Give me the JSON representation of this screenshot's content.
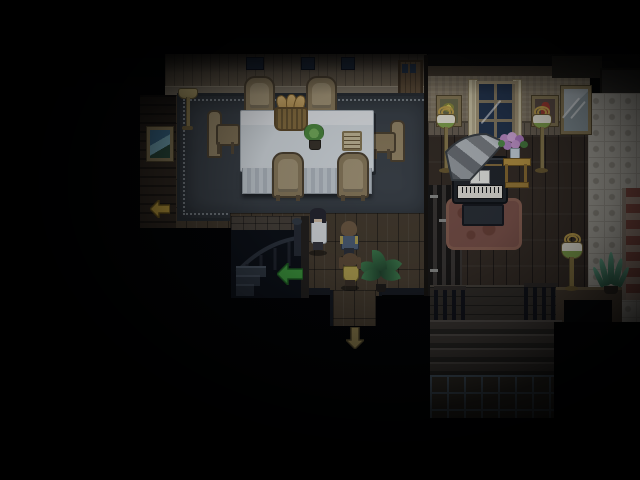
{
  "meta": {
    "genre": "top-down pixel-art RPG interior",
    "time_of_day": "night",
    "hud_text_visible": false
  },
  "scene": {
    "rooms": {
      "dining_room": {
        "label": "dining room",
        "objects": {
          "table": {
            "label": "long dining table with white tablecloth"
          },
          "bread_basket": {
            "label": "wicker basket with bread loaves"
          },
          "centerpiece": {
            "label": "green potted plant centerpiece"
          },
          "book": {
            "label": "open book on table"
          },
          "chair": {
            "label": "wooden dining chair",
            "count": 6
          },
          "rug": {
            "label": "large dark rug with dotted border"
          },
          "floor_lamp": {
            "label": "brass floor lamp"
          },
          "painting": {
            "label": "framed blue painting on left wall"
          },
          "back_door": {
            "label": "wooden door in back wall"
          },
          "small_windows": {
            "label": "dark transom windows",
            "count": 3
          }
        }
      },
      "hallway": {
        "label": "hallway",
        "objects": {
          "stairwell": {
            "label": "dark staircase leading down"
          },
          "houseplant": {
            "label": "potted palm plant"
          }
        }
      },
      "music_room": {
        "label": "music room",
        "objects": {
          "grand_piano": {
            "label": "black grand piano with open lid and sheet music"
          },
          "piano_bench": {
            "label": "piano bench"
          },
          "piano_rug": {
            "label": "round dusty-red rug"
          },
          "window": {
            "label": "night window with cream curtains"
          },
          "painting_flowers": {
            "label": "framed still-life painting"
          },
          "painting_portrait": {
            "label": "framed portrait in red"
          },
          "floor_lamp_left": {
            "label": "floor lamp with green-trimmed shade"
          },
          "floor_lamp_right": {
            "label": "floor lamp with green-trimmed shade"
          },
          "mirror": {
            "label": "wall mirror"
          },
          "flower_stand": {
            "label": "side table with vase of pink flowers"
          },
          "green_lamp": {
            "label": "floor lamp on patterned floor"
          },
          "aloe_plant": {
            "label": "spiky potted plant"
          },
          "patterned_floor": {
            "label": "light patterned tile area with red medallion border"
          }
        }
      },
      "foyer_stairs": {
        "label": "wide staircase to lower floor",
        "objects": {
          "railing": {
            "label": "banister with balusters"
          },
          "steps": {
            "label": "wooden steps"
          },
          "tile_floor": {
            "label": "checkered tile landing"
          }
        }
      }
    },
    "characters": [
      {
        "id": "adult-in-white-coat",
        "description": "dark-haired adult in a white coat, facing the viewer",
        "location": "hallway"
      },
      {
        "id": "boy-in-overalls",
        "description": "brown-haired boy in blue overalls over a yellow shirt, facing away",
        "location": "hallway"
      },
      {
        "id": "girl-in-yellow-dress",
        "description": "girl with pigtails in a yellow dress, facing away",
        "location": "hallway"
      }
    ],
    "exit_arrows": [
      {
        "id": "west-exit-arrow",
        "direction": "left",
        "color": "#c7a33c"
      },
      {
        "id": "stairs-down-arrow",
        "direction": "left",
        "color": "#3e9a3c"
      },
      {
        "id": "south-exit-arrow",
        "direction": "down",
        "color": "#93824e"
      }
    ],
    "palette": {
      "background": "#000000",
      "floor_wood": "#463b2d",
      "rug": "#3d4349",
      "tablecloth": "#e3e7ea",
      "piano_black": "#22262b",
      "piano_rug_red": "#7b5147",
      "window_night": "#24344e",
      "pattern_floor": "#b0aca2",
      "red_medallion": "#7e463c",
      "chair_wood": "#8d7c5c"
    }
  }
}
